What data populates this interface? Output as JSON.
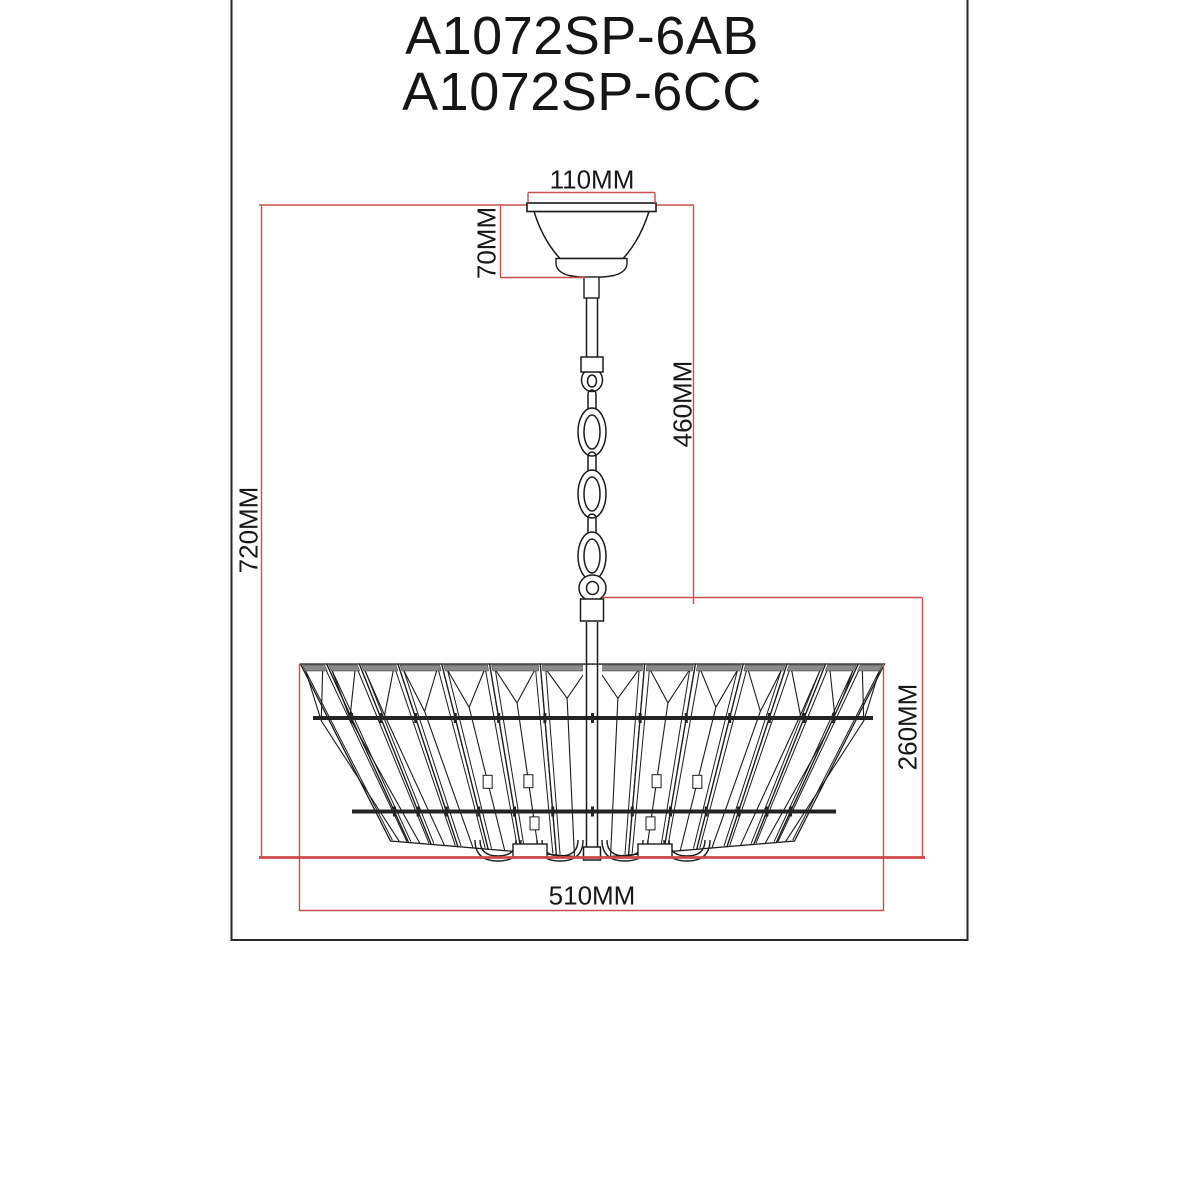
{
  "title": {
    "line1": "A1072SP-6AB",
    "line2": "A1072SP-6CC"
  },
  "dimensions": {
    "canopy_width": "110MM",
    "canopy_height": "70MM",
    "chain_length": "460MM",
    "total_height": "720MM",
    "shade_height": "260MM",
    "shade_width": "510MM"
  },
  "colors": {
    "dimension_line": "#c85050",
    "dimension_line_bold": "#d04848",
    "outline": "#1c1c1c"
  }
}
